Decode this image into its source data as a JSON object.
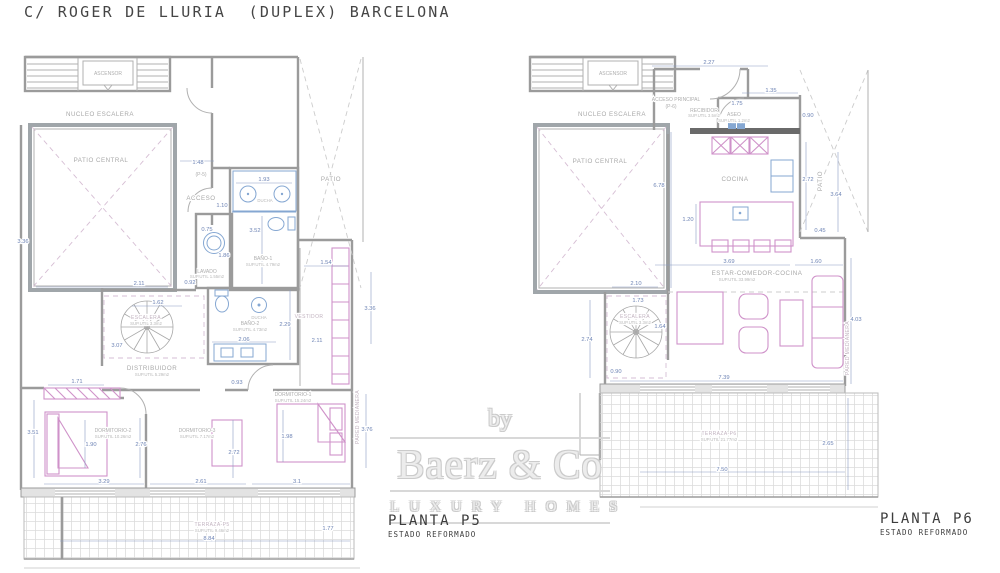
{
  "title": "C/ ROGER DE LLURIA  (DUPLEX) BARCELONA",
  "watermark": {
    "by": "by",
    "brand": "Baerz & Co",
    "tagline": "LUXURY HOMES"
  },
  "colors": {
    "wall": "#9b9b9b",
    "dark_wall": "#666666",
    "dimension": "#6e84b5",
    "fixture": "#85a7d2",
    "furniture": "#cf92c9",
    "room_label": "#a9a9a9",
    "terrace_label": "#c2b3c0",
    "title_text": "#454545",
    "watermark": "#d4d4d4"
  },
  "sh": {
    "ascensor": "ASCENSOR",
    "nucleo": "NUCLEO ESCALERA",
    "patio_central": "PATIO CENTRAL",
    "patio": "PATIO",
    "pared": "PARED MEDIANERA",
    "escalera": "ESCALERA",
    "ducha": "DUCHA"
  },
  "p5": {
    "name": "PLANTA P5",
    "status": "ESTADO REFORMADO",
    "rooms": {
      "ref": "(P-5)",
      "acceso": "ACCESO",
      "bano1": "BAÑO-1",
      "bano1_sup": "SUP.UTIL 4.79m2",
      "lavado": "LAVADO",
      "lavado_sup": "SUP.UTIL 1.55m2",
      "vestidor": "VESTIDOR",
      "escalera_sup": "SUP.UTIL 3.3m2",
      "distribuidor": "DISTRIBUIDOR",
      "distribuidor_sup": "SUP.UTIL 5.29m2",
      "bano2": "BAÑO-2",
      "bano2_sup": "SUP.UTIL 4.73m2",
      "dorm1": "DORMITORIO-1",
      "dorm1_sup": "SUP.UTIL 15.24m2",
      "dorm2": "DORMITORIO-2",
      "dorm2_sup": "SUP.UTIL 10.26m2",
      "dorm3": "DORMITORIO-3",
      "dorm3_sup": "SUP.UTIL 7.17m2",
      "terraza": "TERRAZA-P5",
      "terraza_sup": "SUP.UTIL 9.46m2"
    },
    "dims": {
      "w_entrada": "1.48",
      "w_pasillo": "1.10",
      "w_ducha": "1.93",
      "h_bano1": "3.52",
      "w_lavadora": "0.75",
      "h_lavado": "1.86",
      "w_lavado": "0.92",
      "w_vestidor": "1.54",
      "h_vestidor": "3.36",
      "w_pasillo2": "2.11",
      "w_patio": "2.11",
      "h_patio": "3.36",
      "w_escalera": "1.62",
      "h_escalera": "3.07",
      "h_bano2": "2.29",
      "w_bano2": "2.06",
      "w_paso": "0.93",
      "w_armario": "1.71",
      "h_dorm2": "3.51",
      "w_cama2": "1.90",
      "h_dorm2b": "2.76",
      "w_dorm2": "3.29",
      "w_dorm3": "2.61",
      "h_dorm3": "2.72",
      "w_cama1": "1.98",
      "w_dorm1": "3.1",
      "h_dorm1": "3.76",
      "w_terraza": "8.84",
      "w_terraza2": "1.77"
    }
  },
  "p6": {
    "name": "PLANTA P6",
    "status": "ESTADO REFORMADO",
    "rooms": {
      "ref": "(P-6)",
      "acceso": "ACCESO PRINCIPAL",
      "recibidor": "RECIBIDOR",
      "recibidor_sup": "SUP.UTIL 3.5m2",
      "aseo": "ASEO",
      "aseo_sup": "SUP.UTIL 1.2m2",
      "cocina": "COCINA",
      "estar": "ESTAR-COMEDOR-COCINA",
      "estar_sup": "SUP.UTIL 33.99m2",
      "escalera_sup": "SUP.UTIL 3.3m2",
      "terraza": "TERRAZA-P6",
      "terraza_sup": "SUP.UTIL 21.77m2"
    },
    "dims": {
      "w_acceso": "2.27",
      "w_aseo": "1.35",
      "w_recibidor": "1.75",
      "h_aseo": "0.90",
      "h_patio": "6.78",
      "h_cocina": "2.72",
      "h_patiod": "3.64",
      "w_isla": "1.20",
      "h_paso": "0.45",
      "w_comedor": "3.69",
      "w_sofa": "1.60",
      "w_patio": "2.10",
      "w_esc": "1.73",
      "h_esc": "1.64",
      "h_izq": "2.74",
      "w_esc2": "0.90",
      "w_estar": "7.39",
      "h_estar": "4.03",
      "w_terraza": "7.50",
      "h_terraza": "2.65"
    }
  }
}
